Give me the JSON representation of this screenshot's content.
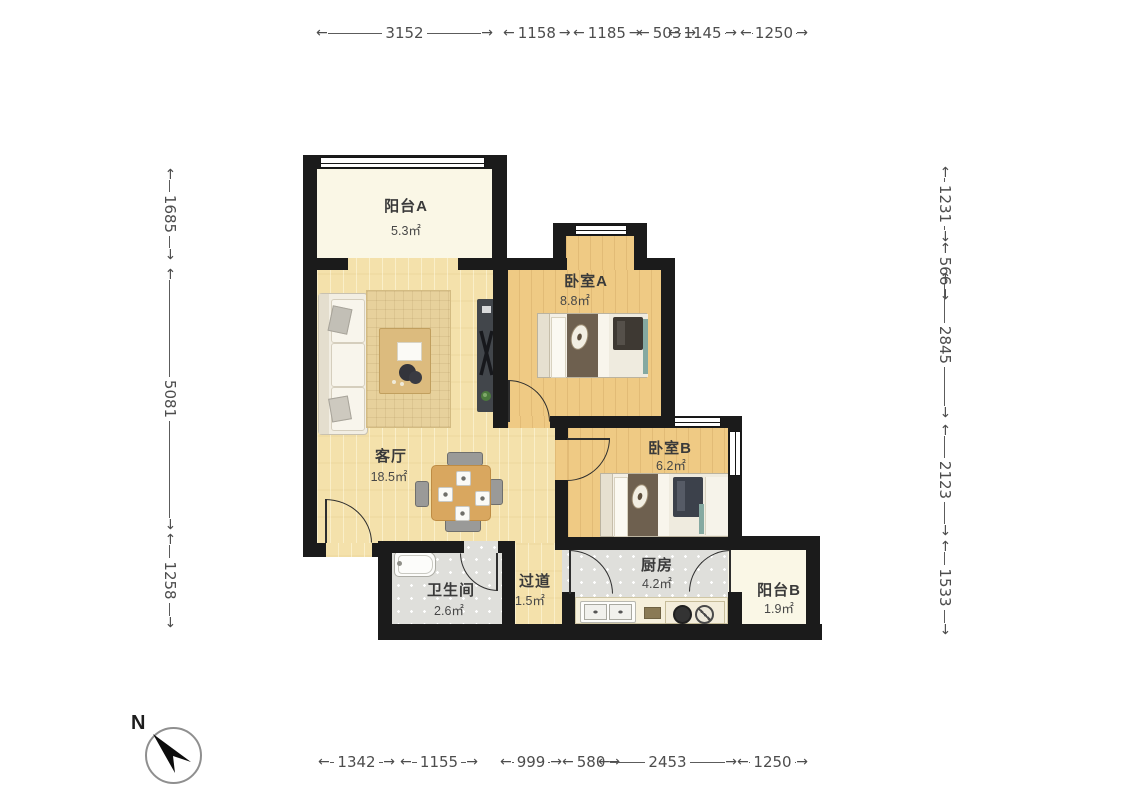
{
  "compass": {
    "label": "N"
  },
  "rooms": [
    {
      "name": "阳台A",
      "area": "5.3㎡"
    },
    {
      "name": "卧室A",
      "area": "8.8㎡"
    },
    {
      "name": "客厅",
      "area": "18.5㎡"
    },
    {
      "name": "卧室B",
      "area": "6.2㎡"
    },
    {
      "name": "卫生间",
      "area": "2.6㎡"
    },
    {
      "name": "过道",
      "area": "1.5㎡"
    },
    {
      "name": "厨房",
      "area": "4.2㎡"
    },
    {
      "name": "阳台B",
      "area": "1.9㎡"
    }
  ],
  "dimensions": {
    "top": [
      "3152",
      "1158",
      "1185",
      "503",
      "1145",
      "1250"
    ],
    "bottom": [
      "1342",
      "1155",
      "999",
      "580",
      "2453",
      "1250"
    ],
    "left": [
      "1685",
      "5081",
      "1258"
    ],
    "right": [
      "1231",
      "566",
      "2845",
      "2123",
      "1533"
    ]
  },
  "colors": {
    "wall": "#1b1b1b",
    "living_floor": "#f4e1ab",
    "bedroom_floor": "#efca84",
    "balcony_floor": "#faf7e6",
    "tile_floor": "#dfdfdb",
    "bed_blanket": "#6e604f",
    "dimension_text": "#4d4d4d"
  }
}
